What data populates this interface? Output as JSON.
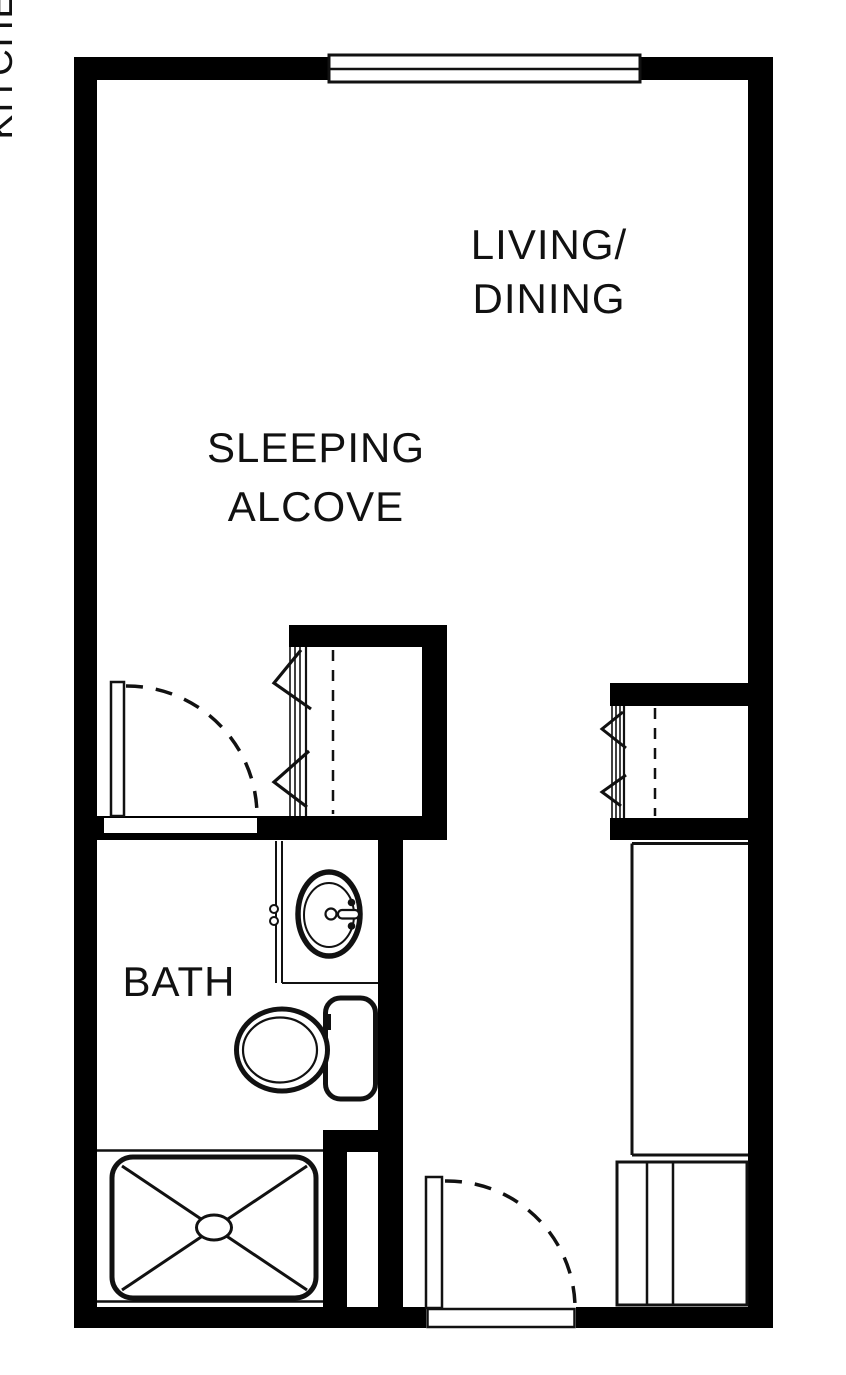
{
  "labels": {
    "living_dining": {
      "line1": "LIVING/",
      "line2": "DINING"
    },
    "sleeping_alcove": {
      "line1": "SLEEPING",
      "line2": "ALCOVE"
    },
    "bath": "BATH",
    "kitchenette": "KITCHENETTE"
  },
  "colors": {
    "wall": "#000000",
    "line": "#111111",
    "background": "#ffffff"
  },
  "symbols": [
    "window-symbol",
    "bath-door-symbol",
    "entry-door-symbol",
    "bifold-closet-alcove-symbol",
    "bifold-closet-kitchen-symbol",
    "vanity-counter-symbol",
    "sink-symbol",
    "toilet-symbol",
    "shower-symbol",
    "kitchenette-counter-symbol",
    "kitchenette-appliance-symbol"
  ]
}
